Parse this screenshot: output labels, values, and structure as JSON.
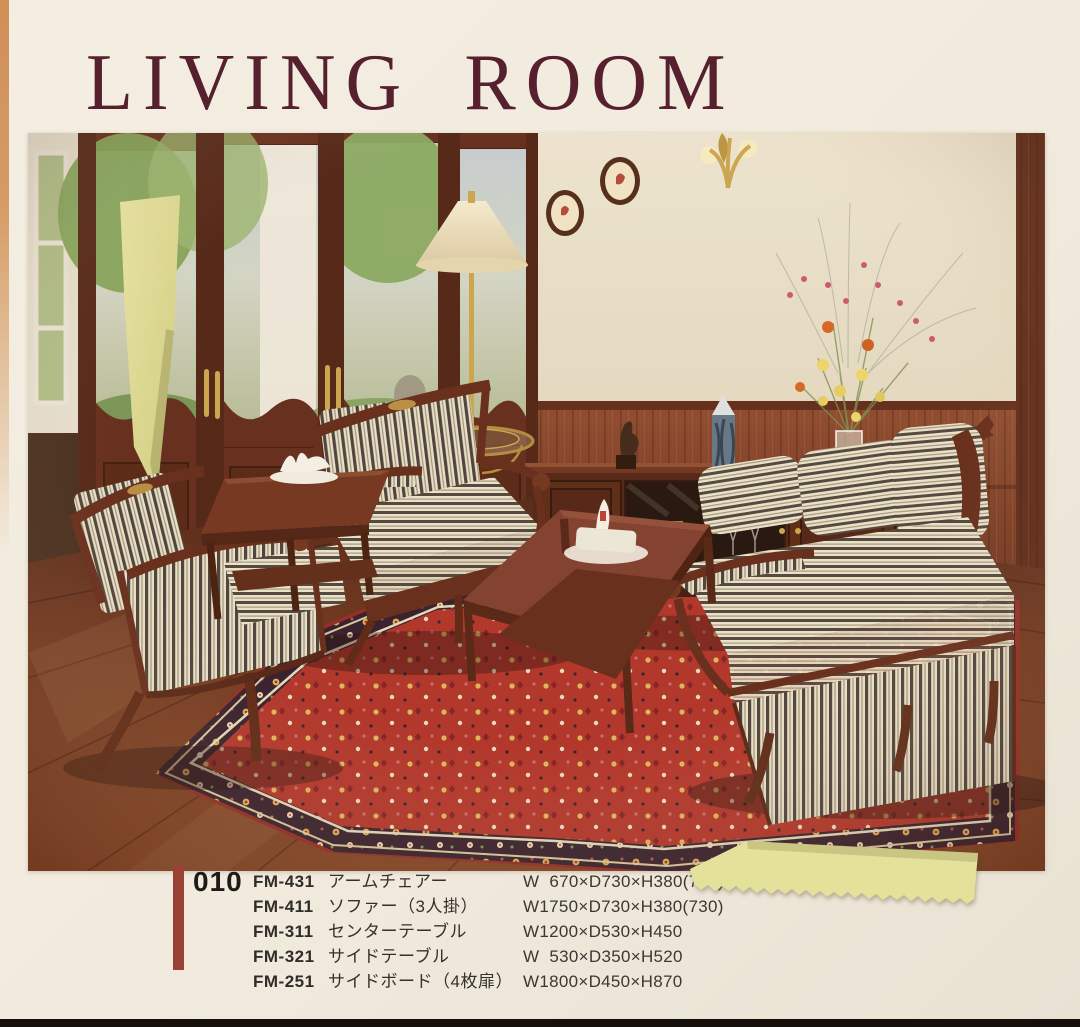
{
  "page": {
    "title": "LIVING ROOM"
  },
  "product_list": {
    "page_number": "010",
    "items": [
      {
        "code": "FM-431",
        "name": "アームチェアー",
        "dimensions": "W  670×D730×H380(730)"
      },
      {
        "code": "FM-411",
        "name": "ソファー（3人掛）",
        "dimensions": "W1750×D730×H380(730)"
      },
      {
        "code": "FM-311",
        "name": "センターテーブル",
        "dimensions": "W1200×D530×H450"
      },
      {
        "code": "FM-321",
        "name": "サイドテーブル",
        "dimensions": "W  530×D350×H520"
      },
      {
        "code": "FM-251",
        "name": "サイドボード（4枚扉）",
        "dimensions": "W1800×D450×H870"
      }
    ]
  },
  "photo": {
    "contents": "living room set: two striped armchairs, three-seat striped sofa, center table, side table, four-door sideboard, red oriental rug, floor lamp, french doors",
    "sticky_notes": 2
  },
  "colors": {
    "page_background": "#f1eadd",
    "title": "#56202e",
    "accent_bar": "#9a4136",
    "sticky_note": "#dedc96",
    "list_text": "#33312c",
    "mahogany": "#5d2516",
    "rug_red": "#ad2d24"
  }
}
